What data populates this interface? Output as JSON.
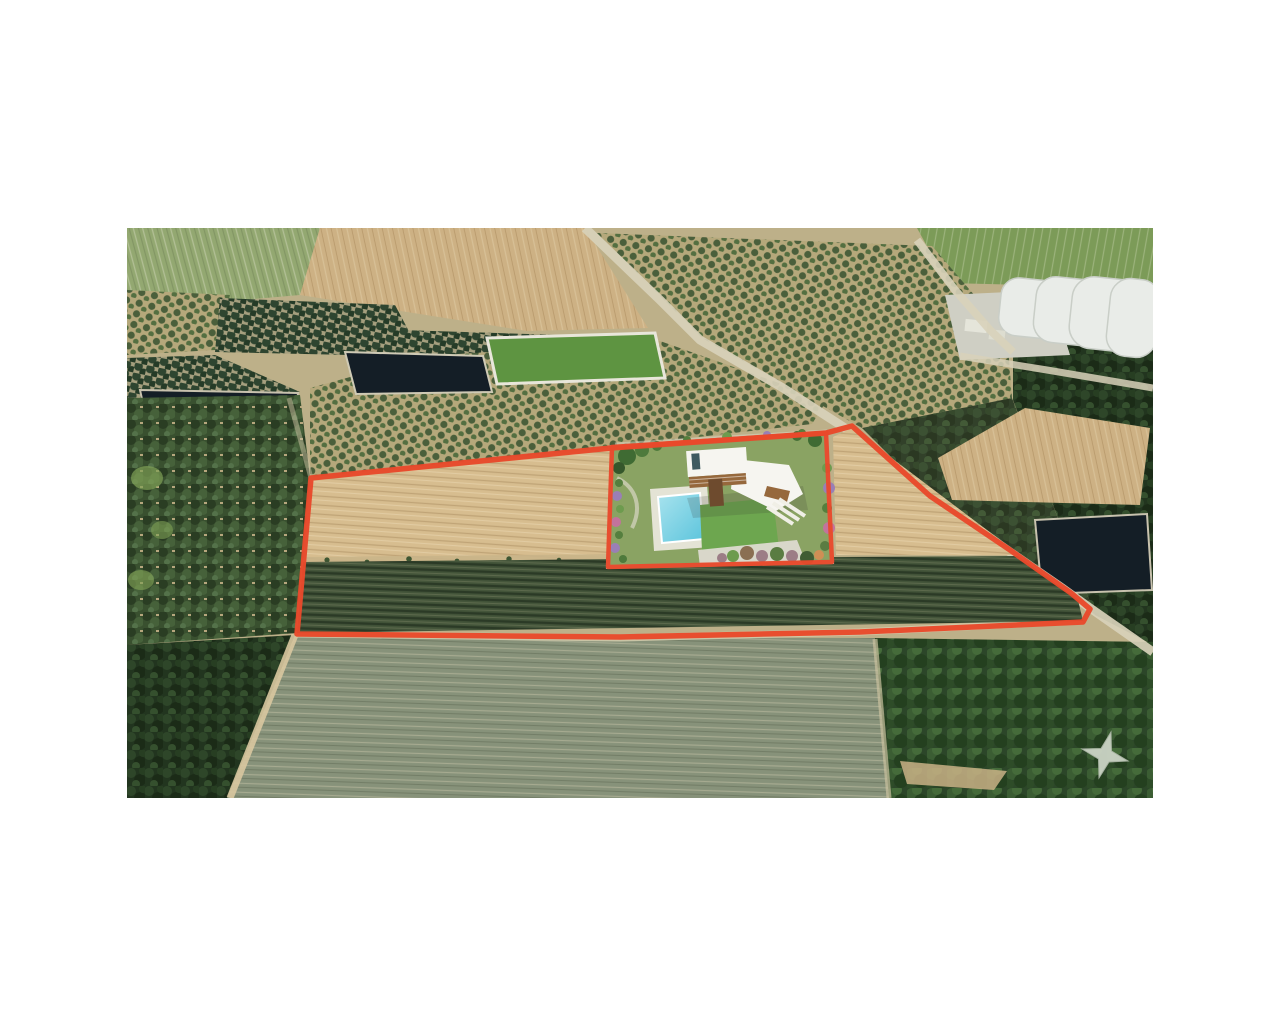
{
  "scene": {
    "type": "aerial-property-photo",
    "features": [
      "plowed-field",
      "vineyard-rows",
      "olive-orchard",
      "forest",
      "scrubland",
      "irrigation-pond",
      "water-channel",
      "walled-green-field",
      "greenhouses",
      "rural-road",
      "dirt-road",
      "property-boundary",
      "villa-render",
      "swimming-pool",
      "lawn",
      "garden-shrubs",
      "star-landmark"
    ]
  },
  "colors": {
    "background": "#FFFFFF",
    "base_ground": "#BDB089",
    "outline": "#E8492B",
    "tan_field": "#CDB184",
    "tan_plot": "#D7BD8F",
    "green_field_tl": "#93A871",
    "green_field_tr": "#7C9B58",
    "walled_field": "#5E9441",
    "vineyard": "#44553A",
    "stubble": "#87927A",
    "forest": "#22351F",
    "forest_dense": "#2C4629",
    "scrub": "#39502F",
    "orchard_ground": "#B5A87B",
    "orchard_ground_pale": "#A59F7E",
    "pond": "#141E26",
    "road": "#D8D1BA",
    "dirt_road": "#D9C8A0",
    "greenhouse": "#E9ECE8",
    "yard": "#CFCFC4",
    "wall": "#C5BFAE",
    "terrace": "#DDDAD0",
    "house_white": "#F6F5F0",
    "wood": "#96683C",
    "wood_dark": "#6E4B2E",
    "skylight": "#3E5A60",
    "pool_light": "#A8E3EE",
    "pool_deep": "#5BC4DC",
    "lawn": "#6DA64F",
    "garden_base": "#8AA363",
    "tree_dark": "#3F6B33",
    "shrub_green": "#557F3E",
    "shrub_purple": "#9A7FB5",
    "shrub_pink": "#C2739C",
    "shrub_mauve": "#9C7D86",
    "shrub_orange": "#CF8F55",
    "star": "#CBD4C5"
  }
}
